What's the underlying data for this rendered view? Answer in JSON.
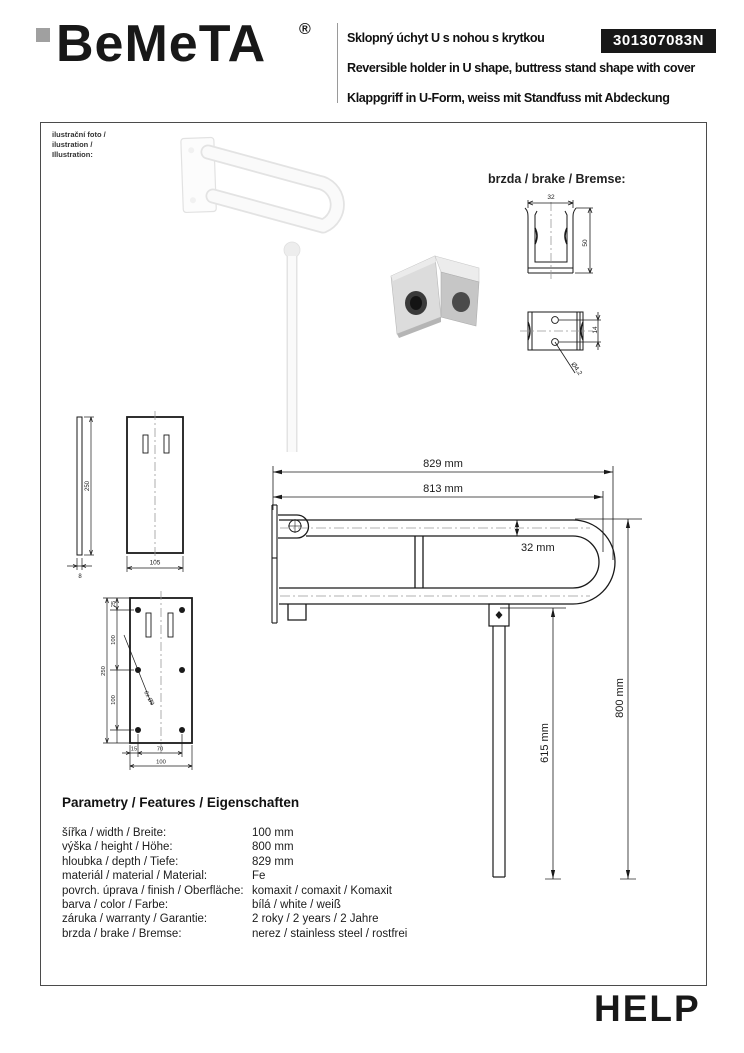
{
  "header": {
    "brand": "BeMeTA",
    "registered": "®",
    "title_cs": "Sklopný úchyt U s nohou s krytkou",
    "title_en": "Reversible holder in U shape, buttress stand shape with cover",
    "title_de": "Klappgriff in U-Form, weiss mit Standfuss mit Abdeckung",
    "product_code": "301307083N"
  },
  "illustration": {
    "caption_line1": "ilustrační foto /",
    "caption_line2": "ilustration /",
    "caption_line3": "Illustration:"
  },
  "brake": {
    "label": "brzda / brake / Bremse:",
    "front_width": "32",
    "front_height": "50",
    "side_hole_spacing": "14",
    "side_hole_diameter": "Ø4,2"
  },
  "drawings": {
    "cover_side_height": "250",
    "cover_side_thickness": "8",
    "cover_front_width": "105",
    "mount_top_offset": "25",
    "mount_spacing1": "100",
    "mount_spacing2": "100",
    "mount_total_height": "250",
    "mount_bottom_left": "15",
    "mount_bottom_center": "70",
    "mount_bottom_total": "100",
    "mount_holes_label": "6x Ø9",
    "main_total_length": "829 mm",
    "main_inner_length": "813 mm",
    "main_tube_diameter": "32 mm",
    "main_leg_height": "615 mm",
    "main_overall_height": "800 mm"
  },
  "parameters": {
    "heading": "Parametry / Features / Eigenschaften",
    "rows": [
      {
        "label": "šířka / width / Breite:",
        "value": "100 mm"
      },
      {
        "label": "výška / height / Höhe:",
        "value": "800 mm"
      },
      {
        "label": "hloubka / depth / Tiefe:",
        "value": "829 mm"
      },
      {
        "label": "materiál / material / Material:",
        "value": "Fe"
      },
      {
        "label": "povrch. úprava / finish / Oberfläche:",
        "value": "komaxit / comaxit / Komaxit"
      },
      {
        "label": "barva / color / Farbe:",
        "value": "bílá / white / weiß"
      },
      {
        "label": "záruka / warranty / Garantie:",
        "value": "2 roky / 2 years / 2 Jahre"
      },
      {
        "label": "brzda / brake / Bremse:",
        "value": "nerez / stainless steel / rostfrei"
      }
    ]
  },
  "footer": {
    "logo": "HELP"
  },
  "colors": {
    "line_black": "#1a1a1a",
    "logo_gray": "#a0a0a0",
    "code_box_bg": "#181818",
    "border_gray": "#4b4b4b"
  }
}
